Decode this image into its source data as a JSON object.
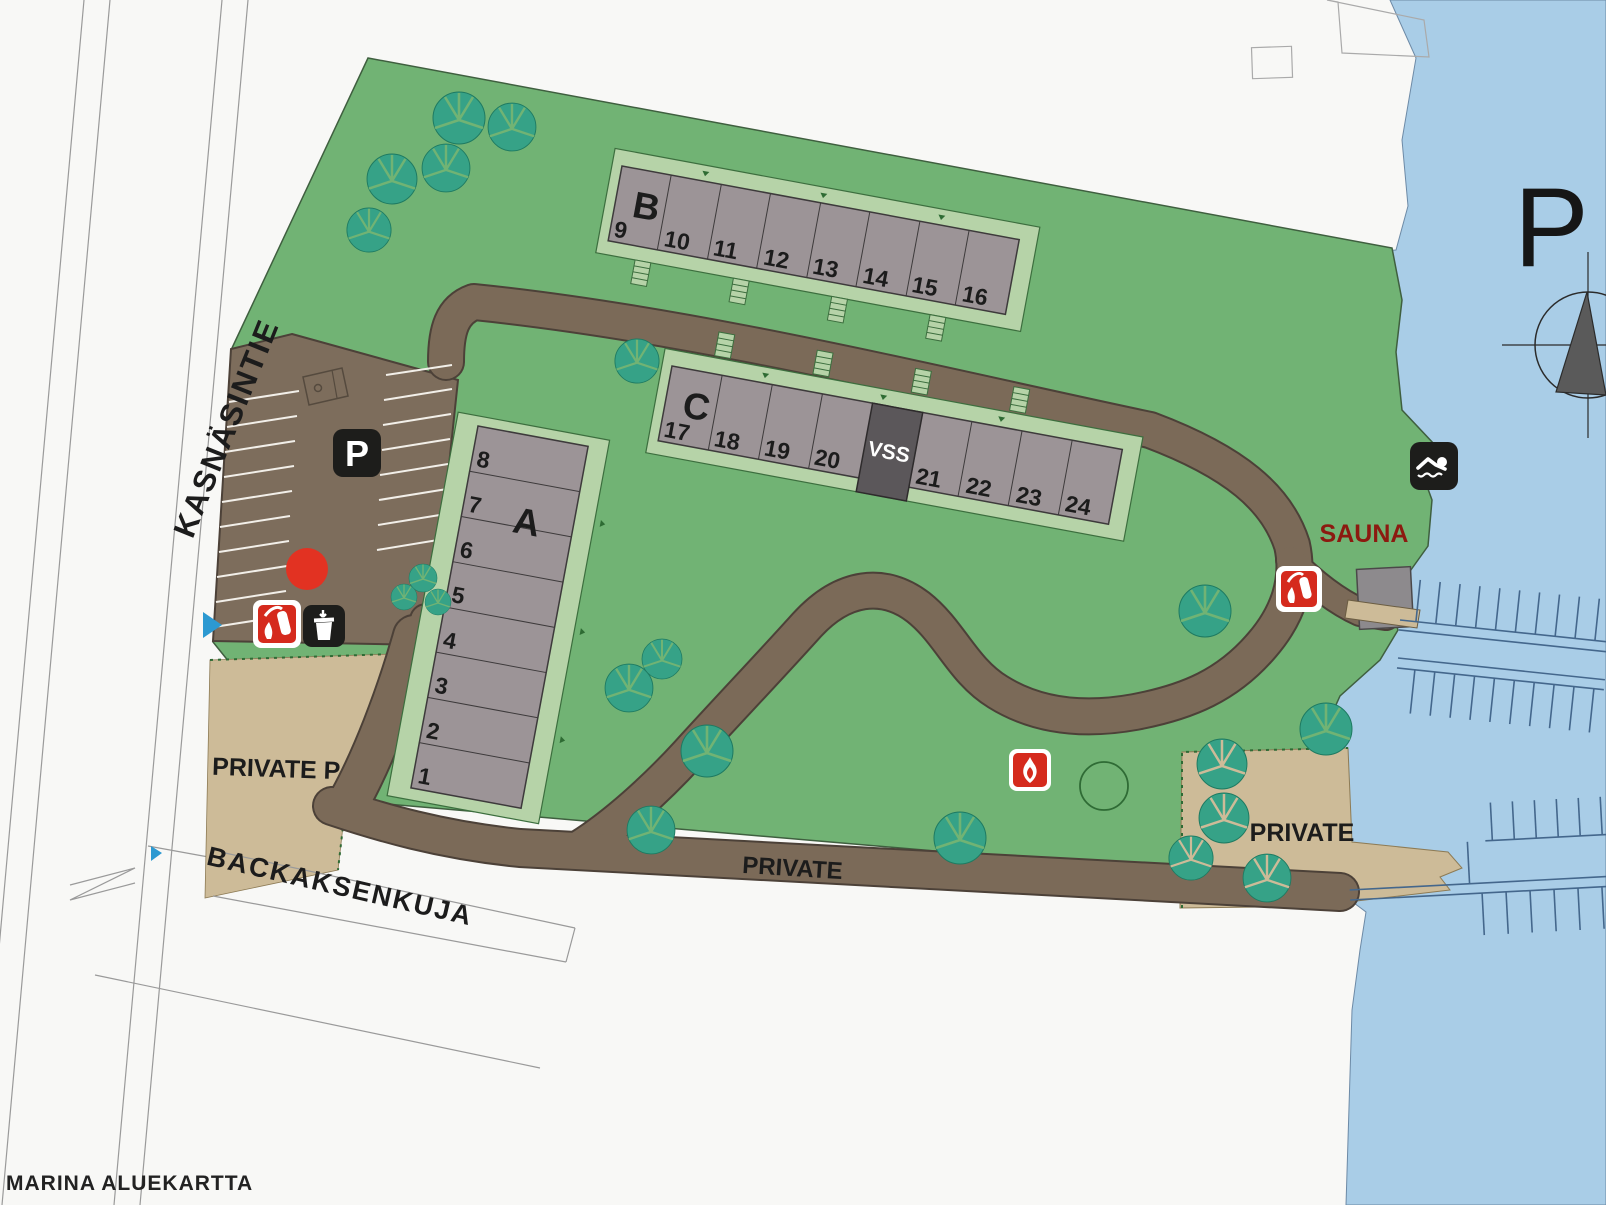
{
  "map": {
    "footer": "MARINA   ALUEKARTTA",
    "north_letter": "P",
    "streets": {
      "kasnasintie": "KASNÄSINTIE",
      "backaksenkuja": "BACKAKSENKUJA"
    },
    "labels": {
      "sauna": "SAUNA",
      "private_p": "PRIVATE P",
      "private_road": "PRIVATE",
      "private_area": "PRIVATE",
      "parking_sign": "P",
      "shelter": "VSS"
    },
    "buildings": {
      "a": {
        "label": "A",
        "units": [
          "1",
          "2",
          "3",
          "4",
          "5",
          "6",
          "7",
          "8"
        ]
      },
      "b": {
        "label": "B",
        "units": [
          "9",
          "10",
          "11",
          "12",
          "13",
          "14",
          "15",
          "16"
        ]
      },
      "c": {
        "label": "C",
        "units": [
          "17",
          "18",
          "19",
          "20",
          "21",
          "22",
          "23",
          "24"
        ]
      }
    },
    "icons": {
      "fire_extinguisher": "fire-extinguisher",
      "waste_bin": "waste-bin",
      "campfire": "campfire",
      "swimming": "swimming-area",
      "parking": "parking",
      "compass": "compass-north"
    },
    "colors": {
      "water": "#a9cde7",
      "grass": "#71b374",
      "road": "#7b6a58",
      "parking": "#7d6d5c",
      "sand": "#cdbb98",
      "building": "#9c9497",
      "platform": "#b6d3a8",
      "shelter": "#5b575a",
      "tree": "#36a287",
      "icon_red": "#d52a1d",
      "location_dot": "#e23222",
      "sauna_text": "#8c1a10",
      "marker_blue": "#2c99d1"
    }
  }
}
